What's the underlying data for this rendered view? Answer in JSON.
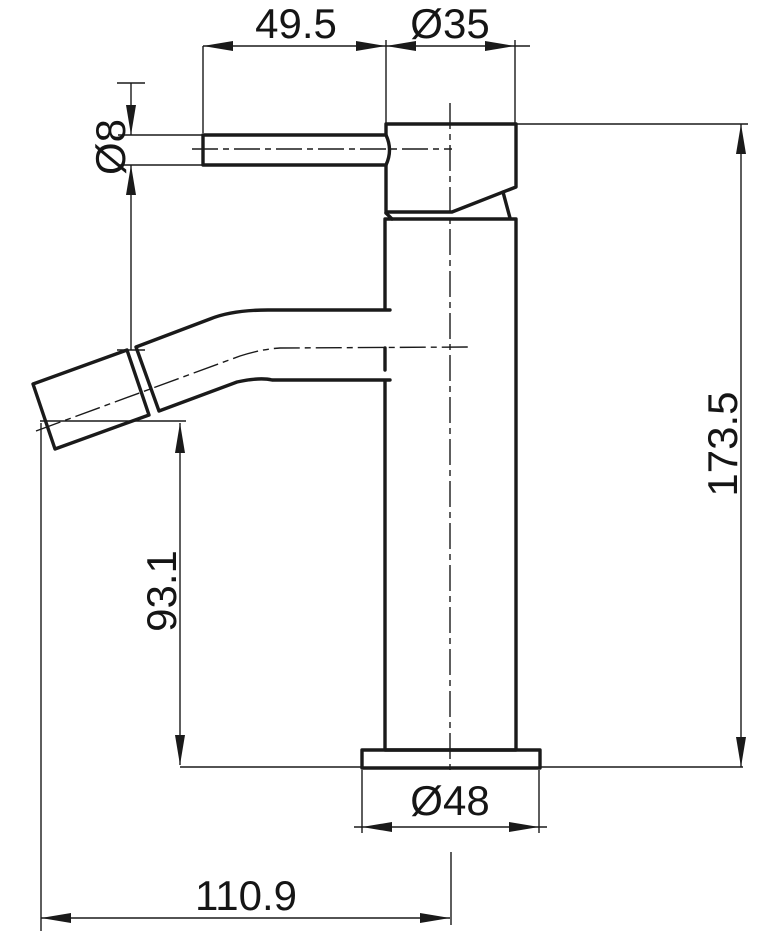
{
  "drawing": {
    "subject": "Single-lever basin mixer tap - dimensioned side elevation",
    "units": "mm",
    "line_color": "#1a1a1a",
    "background_color": "#ffffff",
    "dims": {
      "handle_length": "49.5",
      "head_diameter": "Ø35",
      "handle_bar_diameter": "Ø8",
      "overall_height": "173.5",
      "spout_outlet_height": "93.1",
      "base_diameter": "Ø48",
      "spout_reach": "110.9"
    }
  }
}
